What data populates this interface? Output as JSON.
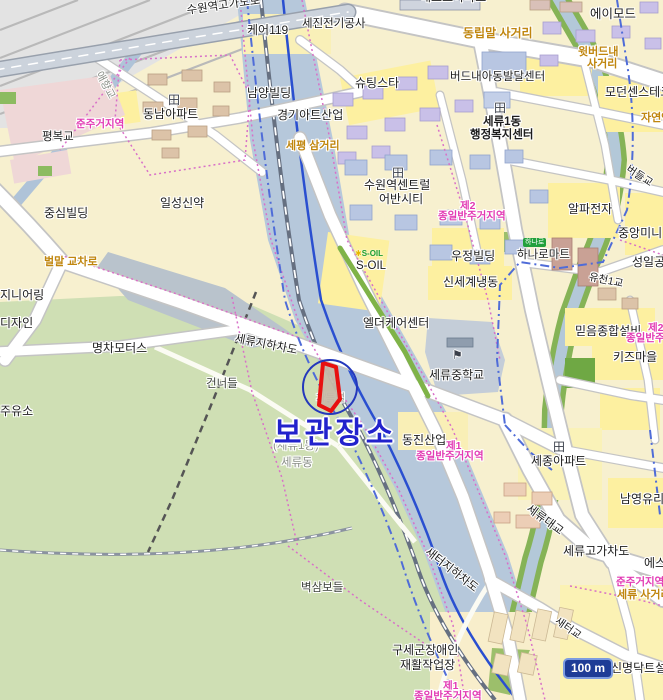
{
  "map": {
    "scale_label": "100 m",
    "annotation": {
      "label": "보관장소"
    },
    "colors": {
      "annotation_text": "#2222cc",
      "annotation_circle": "#2438bc",
      "highlight_outline": "#e81010",
      "junction_label": "#c0860e",
      "zoning_label": "#e23ab4",
      "water": "#b6c8db",
      "green_field": "#cfdfb4",
      "scale_badge_bg": "#1e3c96"
    },
    "icons": {
      "apartment": "田",
      "school_flag": "⚑",
      "star": "✱"
    },
    "labels": {
      "suwon_overpass": "수원역고가도로",
      "care119": "케어119",
      "sejin_elec": "세진전기공사",
      "top_cut_apart": "해모로아파트",
      "amode": "에이모드",
      "dongnipmal": "동립말 사거리",
      "witbeodeunae1": "윗버드내",
      "witbeodeunae2": "사거리",
      "shootingstar": "슈팅스타",
      "beodeunae_center": "버드내아동발달센터",
      "modern_sense": "모던센스테크",
      "seryu1dong": "세류1동",
      "haengbok_center": "행정복지센터",
      "namyang": "남양빌딩",
      "ggart": "경기아트산업",
      "junju_tl": "준주거지역",
      "pyeongbok": "평복교",
      "aehyang": "애향교",
      "sepyeong": "세평 삼거리",
      "central1": "수원역센트럴",
      "central2": "어반시티",
      "je2_a": "제2",
      "je2_b": "종일반주거지역",
      "soil_brand": "S-OIL",
      "soil": "S-OIL",
      "woojung": "우정빌딩",
      "shinsegae": "신세계냉동",
      "hanaro_brand": "하나로",
      "hanaro": "하나로마트",
      "alpha": "알파전자",
      "beodeul_bridge": "버들교",
      "jungang": "중앙미니",
      "seongil": "성일공업",
      "yucheon_bridge": "유천1교",
      "mideum": "믿음종합설비",
      "je2r_a": "제2",
      "je2r_b": "종일반주거지역",
      "kids": "키즈마을",
      "seryu_middle_school": "세류중학교",
      "elder": "엘더케어센터",
      "seryu_underpass": "세류지하차도",
      "chadeuk": "차득벌",
      "seryu1_paren": "(세류1동)",
      "seryudong": "세류동",
      "dongjin": "동진산업",
      "je1_a": "제1",
      "je1_b": "종일반주거지역",
      "sejong_apt": "세종아파트",
      "namyoung_glass": "남영유리",
      "seryu_bridge": "세류대교",
      "seryu_overpass2": "세류고가차도",
      "es_cut": "에스",
      "junju_r": "준주거지역",
      "seryu_junction": "세류 사거리",
      "saeteo_bridge": "새터교",
      "saeteo_underpass": "새터지하차도",
      "byeoksam": "벽삼보들",
      "salvation1": "구세군장애인",
      "salvation2": "재활작업장",
      "je1b_a": "제1",
      "je1b_b": "종일반주거지역",
      "shinmyung": "신명닥트설비",
      "jungsim": "중심빌딩",
      "ilsung": "일성신약",
      "beolmal": "벌말 교차로",
      "eng_cut": "지니어링",
      "design_cut": "디자인",
      "gas_cut": "주유소",
      "myeongcha": "명차모터스",
      "geonneodeul": "건너들",
      "jayeon": "자연앤",
      "dongnam_apt": "동남아파트"
    }
  }
}
